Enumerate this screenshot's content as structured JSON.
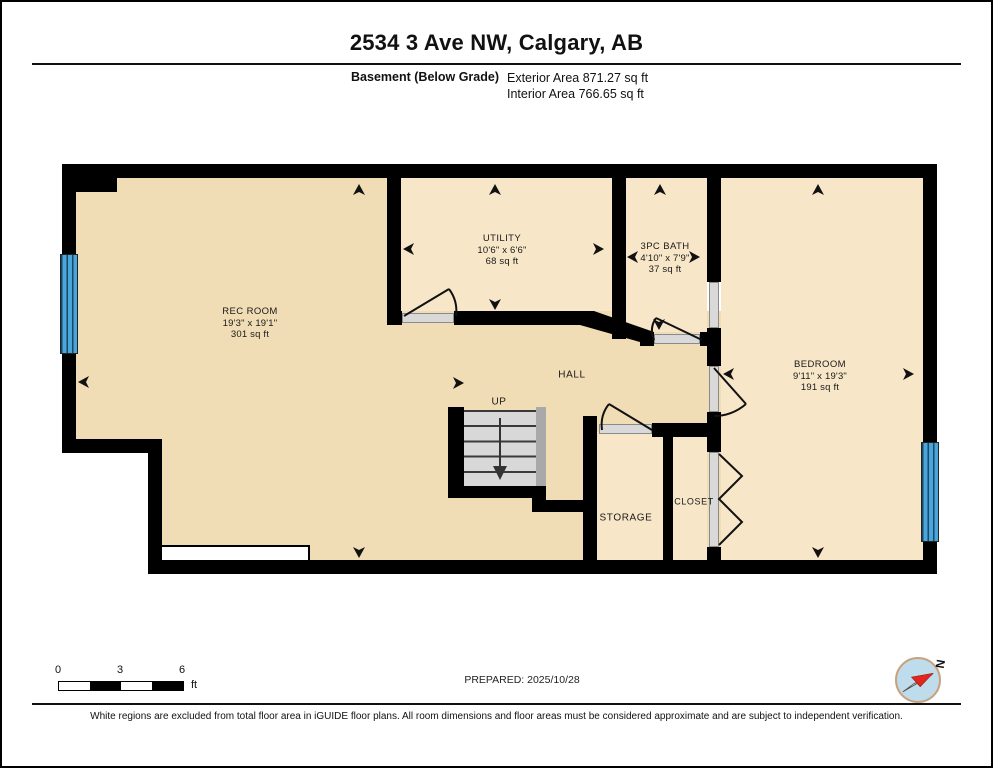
{
  "header": {
    "title": "2534 3 Ave NW, Calgary, AB",
    "floor_label": "Basement (Below Grade)",
    "exterior_area": "Exterior Area 871.27 sq ft",
    "interior_area": "Interior Area 766.65 sq ft"
  },
  "rooms": {
    "rec_room": {
      "name": "REC ROOM",
      "dimensions": "19'3\" x 19'1\"",
      "area": "301 sq ft"
    },
    "utility": {
      "name": "UTILITY",
      "dimensions": "10'6\" x 6'6\"",
      "area": "68 sq ft"
    },
    "bath": {
      "name": "3PC BATH",
      "dimensions": "4'10\" x 7'9\"",
      "area": "37 sq ft"
    },
    "bedroom": {
      "name": "BEDROOM",
      "dimensions": "9'11\" x 19'3\"",
      "area": "191 sq ft"
    },
    "hall": {
      "name": "HALL"
    },
    "storage": {
      "name": "STORAGE"
    },
    "closet": {
      "name": "CLOSET"
    },
    "stairs": {
      "name": "UP"
    }
  },
  "footer": {
    "scale": {
      "ticks": [
        "0",
        "3",
        "6"
      ],
      "unit": "ft"
    },
    "prepared": "PREPARED: 2025/10/28",
    "compass_label": "N",
    "disclaimer": "White regions are excluded from total floor area in iGUIDE floor plans. All room dimensions and floor areas must be considered approximate and are subject to independent verification."
  },
  "colors": {
    "floor_main": "#f0dcb5",
    "floor_light": "#f7e6c8",
    "wall": "#000000",
    "window_glass": "#49a5da",
    "stair_tread": "#d8d8d8",
    "stair_rail": "#a9a9a9",
    "door_threshold": "#d9d9d9",
    "compass_fill": "#bfdcec",
    "compass_needle_red": "#e3261d"
  }
}
